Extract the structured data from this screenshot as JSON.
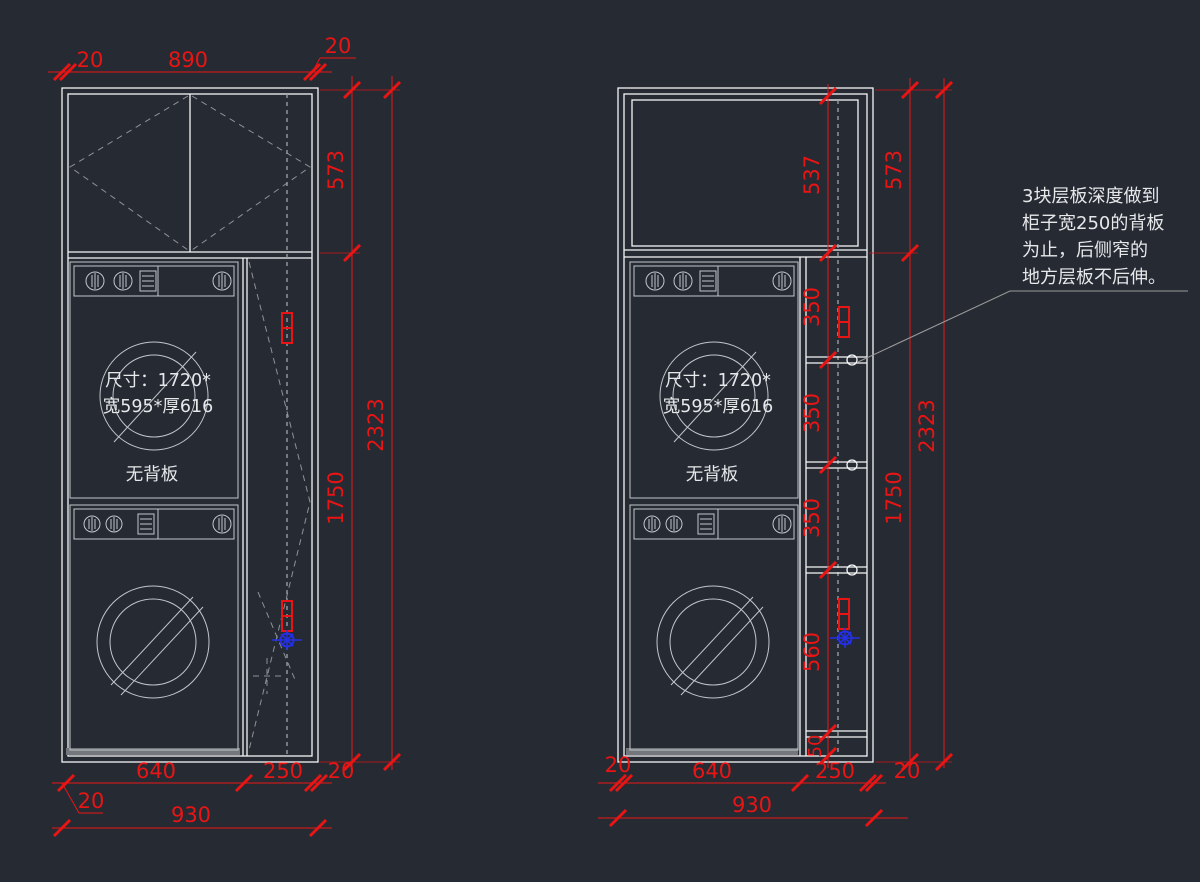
{
  "machine": {
    "size_line1": "尺寸：1720*",
    "size_line2": "宽595*厚616",
    "no_back_panel": "无背板"
  },
  "note": {
    "line1": "3块层板深度做到",
    "line2": "柜子宽250的背板",
    "line3": "为止，后侧窄的",
    "line4": "地方层板不后伸。"
  },
  "left_dims": {
    "top_left_20": "20",
    "top_890": "890",
    "top_right_20": "20",
    "right_573": "573",
    "right_1750": "1750",
    "right_2323": "2323",
    "bottom_640": "640",
    "bottom_250": "250",
    "bottom_right_20": "20",
    "bottom_left_20": "20",
    "bottom_930": "930"
  },
  "right_dims": {
    "inner_537": "537",
    "shelf_350_a": "350",
    "shelf_350_b": "350",
    "shelf_350_c": "350",
    "inner_560": "560",
    "inner_50": "50",
    "right_573": "573",
    "right_1750": "1750",
    "right_2323": "2323",
    "bottom_left_20": "20",
    "bottom_640": "640",
    "bottom_250": "250",
    "bottom_right_20": "20",
    "bottom_930": "930"
  },
  "colors": {
    "background": "#262a33",
    "cabinet_line": "#f5f6f7",
    "machine_line": "#c2c7cb",
    "dimension_red": "#e91515",
    "marker_blue": "#2330e8",
    "dashed_gray": "#8f9296",
    "text_light": "#e6e8ea"
  }
}
